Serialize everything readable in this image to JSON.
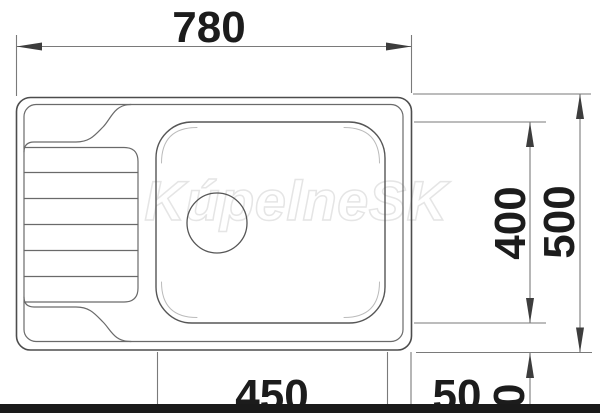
{
  "drawing": {
    "kind": "technical-dimension-drawing",
    "subject": "kitchen sink top view with left drainboard and right basin",
    "watermark_text": "KúpelneSK"
  },
  "dimensions": {
    "overall_width": "780",
    "basin_depth": "400",
    "overall_depth": "500",
    "basin_width": "450",
    "edge_gap": "50",
    "lower_offset": "50"
  },
  "colors": {
    "background": "#ffffff",
    "outline": "#4d4d4d",
    "thin_line": "#6a6a6a",
    "basin_line": "#565656",
    "faint_line": "#bbbbbb",
    "dim_line": "#7a7a7a",
    "arrow": "#3d3d3d",
    "text": "#1c1c1c",
    "watermark_stroke": "#e5e5e5",
    "watermark_fill": "#ffffff",
    "bottom_bar": "#1a1a1a"
  }
}
